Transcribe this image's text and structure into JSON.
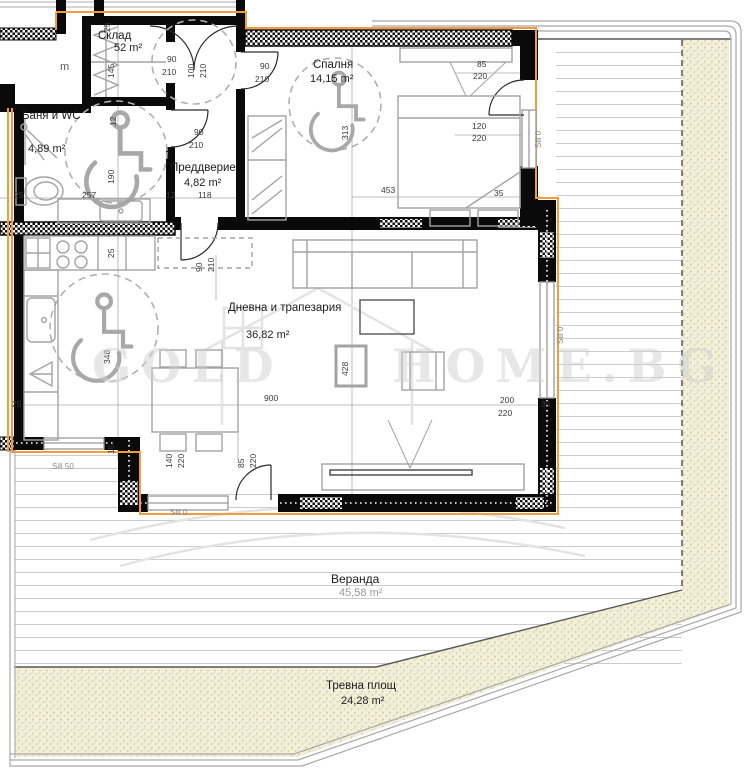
{
  "title": "Apartment floor plan",
  "watermark": {
    "left": "GOLD",
    "right": "HOME.BG"
  },
  "rooms": {
    "storage": {
      "name": "Склад",
      "area": "52 m²"
    },
    "bath": {
      "name": "Баня и WC",
      "area": "4,89 m²"
    },
    "entry": {
      "name": "Преддверие",
      "area": "4,82 m²"
    },
    "bedroom": {
      "name": "Спалня",
      "area": "14,15 m²"
    },
    "living": {
      "name": "Дневна и трапезария",
      "area": "36,82 m²"
    },
    "veranda": {
      "name": "Веранда",
      "area": "45,58 m²"
    },
    "lawn": {
      "name": "Тревна площ",
      "area": "24,28 m²"
    }
  },
  "dims": {
    "storage_d": "25",
    "storage_w": "145",
    "d100": "100",
    "d210a": "210",
    "st90": "90",
    "st210": "210",
    "ba90": "90",
    "ba210": "210",
    "bd90": "90",
    "bd210": "210",
    "lv90": "90",
    "lv210": "210",
    "bath12": "12",
    "bath190": "190",
    "row25": "25",
    "row257": "257",
    "row12": "12",
    "row118": "118",
    "bal85": "85",
    "bal220": "220",
    "win120": "120",
    "win220": "220",
    "jog35a": "35",
    "len453": "453",
    "dep313": "313",
    "kit25": "25",
    "cir348": "348",
    "tab428": "428",
    "w200": "200",
    "w220": "220",
    "jog35b": "35",
    "w900": "900",
    "bw140": "140",
    "bw220": "220",
    "bd85": "85",
    "bd220": "220",
    "step15": "15",
    "left25": "25",
    "pm": "m"
  },
  "sills": {
    "s50": "Sill 50",
    "s0a": "Sill 0",
    "s0b": "Sill 0",
    "s0c": "Sill 0"
  },
  "colors": {
    "wall": "#0a0a0a",
    "insulation": "#ef9d3e",
    "boundary": "#a8a8a8",
    "deck_line": "#cccccc",
    "grass_bg": "#f2efda",
    "grass_dot": "#d5cc9e",
    "furniture": "#a3a3a3",
    "dim_text": "#3a3a3a",
    "watermark": "#d0d0d0"
  }
}
